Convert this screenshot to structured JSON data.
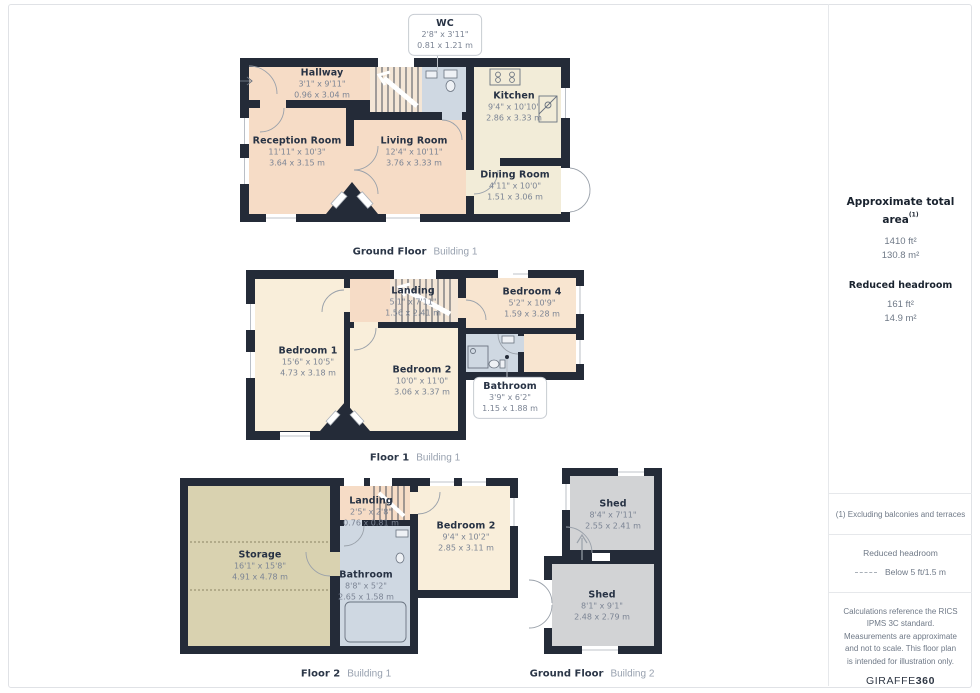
{
  "plans": [
    {
      "floor_label": "Ground Floor",
      "building_label": "Building 1",
      "rooms": [
        {
          "name": "WC",
          "imperial": "2'8\" x 3'11\"",
          "metric": "0.81 x 1.21 m"
        },
        {
          "name": "Hallway",
          "imperial": "3'1\" x 9'11\"",
          "metric": "0.96 x 3.04 m"
        },
        {
          "name": "Reception Room",
          "imperial": "11'11\" x 10'3\"",
          "metric": "3.64 x 3.15 m"
        },
        {
          "name": "Living Room",
          "imperial": "12'4\" x 10'11\"",
          "metric": "3.76 x 3.33 m"
        },
        {
          "name": "Kitchen",
          "imperial": "9'4\" x 10'10\"",
          "metric": "2.86 x 3.33 m"
        },
        {
          "name": "Dining Room",
          "imperial": "4'11\" x 10'0\"",
          "metric": "1.51 x 3.06 m"
        }
      ]
    },
    {
      "floor_label": "Floor 1",
      "building_label": "Building 1",
      "rooms": [
        {
          "name": "Landing",
          "imperial": "5'1\" x 7'11\"",
          "metric": "1.56 x 2.41 m"
        },
        {
          "name": "Bedroom 1",
          "imperial": "15'6\" x 10'5\"",
          "metric": "4.73 x 3.18 m"
        },
        {
          "name": "Bedroom 2",
          "imperial": "10'0\" x 11'0\"",
          "metric": "3.06 x 3.37 m"
        },
        {
          "name": "Bedroom 4",
          "imperial": "5'2\" x 10'9\"",
          "metric": "1.59 x 3.28 m"
        },
        {
          "name": "Bathroom",
          "imperial": "3'9\" x 6'2\"",
          "metric": "1.15 x 1.88 m"
        }
      ]
    },
    {
      "floor_label": "Floor 2",
      "building_label": "Building 1",
      "rooms": [
        {
          "name": "Landing",
          "imperial": "2'5\" x 2'8\"",
          "metric": "0.76 x 0.81 m"
        },
        {
          "name": "Storage",
          "imperial": "16'1\" x 15'8\"",
          "metric": "4.91 x 4.78 m"
        },
        {
          "name": "Bedroom 2",
          "imperial": "9'4\" x 10'2\"",
          "metric": "2.85 x 3.11 m"
        },
        {
          "name": "Bathroom",
          "imperial": "8'8\" x 5'2\"",
          "metric": "2.65 x 1.58 m"
        }
      ]
    },
    {
      "floor_label": "Ground Floor",
      "building_label": "Building 2",
      "rooms": [
        {
          "name": "Shed",
          "imperial": "8'4\" x 7'11\"",
          "metric": "2.55 x 2.41 m"
        },
        {
          "name": "Shed",
          "imperial": "8'1\" x 9'1\"",
          "metric": "2.48 x 2.79 m"
        }
      ]
    }
  ],
  "sidebar": {
    "total_area_title": "Approximate total area",
    "total_area_footnote_marker": "(1)",
    "total_area_imperial": "1410 ft²",
    "total_area_metric": "130.8 m²",
    "reduced_title": "Reduced headroom",
    "reduced_imperial": "161 ft²",
    "reduced_metric": "14.9 m²",
    "footnote": "(1) Excluding balconies and terraces",
    "legend_title": "Reduced headroom",
    "legend_value": "Below 5 ft/1.5 m",
    "disclaimer": "Calculations reference the RICS IPMS 3C standard. Measurements are approximate and not to scale. This floor plan is intended for illustration only.",
    "brand_name": "GIRAFFE",
    "brand_suffix": "360"
  },
  "palette": {
    "wall": "#242b38",
    "hall_living": "#f6dcc6",
    "kitchen_dining": "#f2ecd8",
    "bedroom": "#f9eeda",
    "bedroom_peach": "#f8e5d0",
    "bathroom": "#cfd8e2",
    "storage": "#d9d2b0",
    "shed": "#d2d3d5"
  }
}
